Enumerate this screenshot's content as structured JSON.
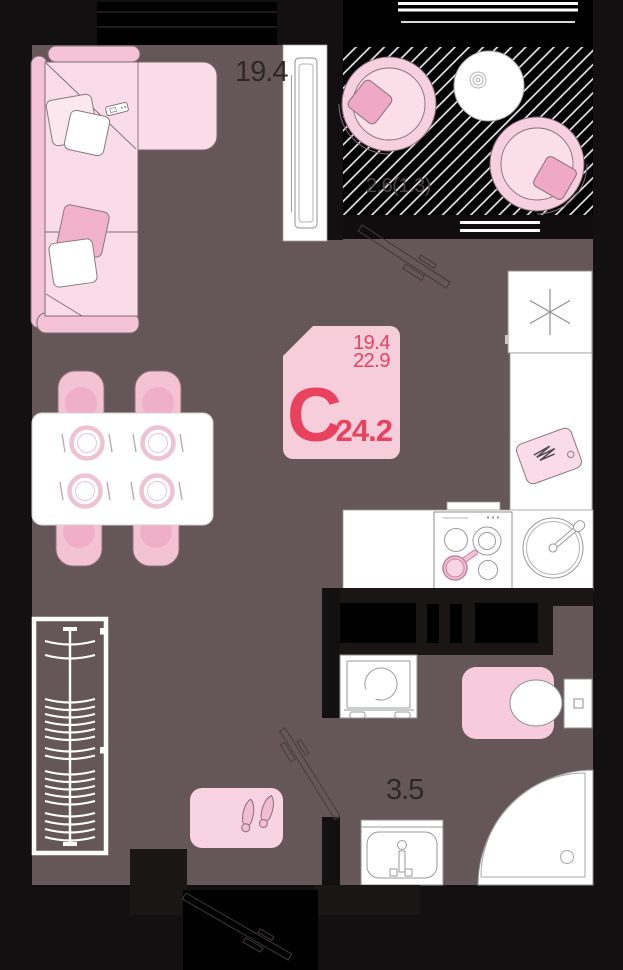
{
  "floorplan": {
    "badge": {
      "type_letter": "С",
      "living_area": "19.4",
      "area_excl_balcony": "22.9",
      "total_area": "24.2"
    },
    "rooms": {
      "living_area": "19.4",
      "balcony_area": "2.6(1.3)",
      "bathroom_area": "3.5"
    },
    "icons": {
      "fridge": "snowflake",
      "balcony_zone": "diagonal-hatch"
    },
    "colors": {
      "floor": "#645659",
      "wall": "#121010",
      "window_black": "#000000",
      "badge_bg": "#f6cedb",
      "accent_red": "#e8425f",
      "furniture_pink_light": "#f9dce7",
      "furniture_pink": "#f3c3d4",
      "furniture_pink_dark": "#f2b2ca",
      "fixture_white": "#ffffff"
    }
  }
}
